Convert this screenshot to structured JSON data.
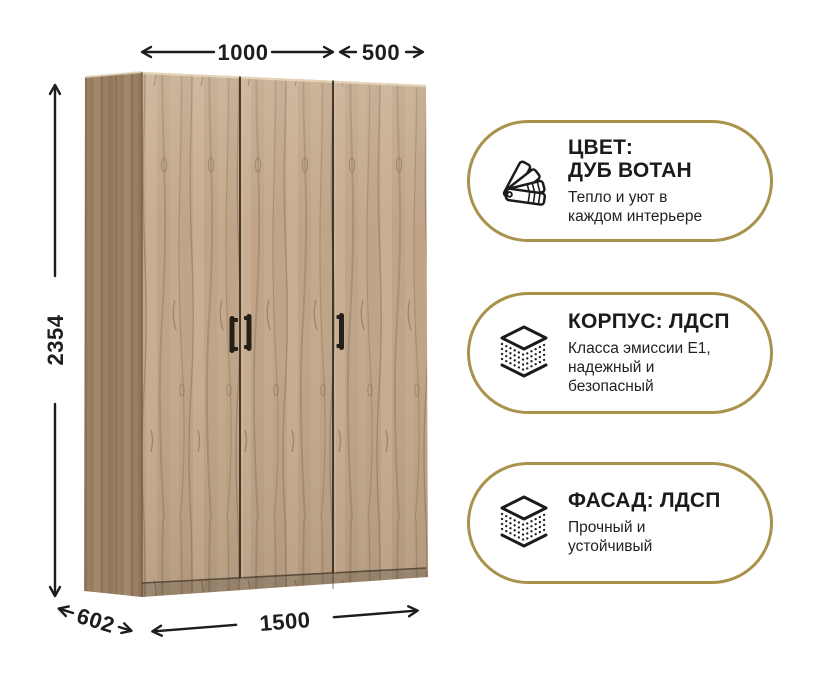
{
  "colors": {
    "accent_gold": "#a8924c",
    "text": "#1d1d1d",
    "wood_front": "#bfa487",
    "wood_side": "#a4886a",
    "handle": "#241f19"
  },
  "dimensions": {
    "top_left_width": "1000",
    "top_right_width": "500",
    "height": "2354",
    "depth": "602",
    "total_width": "1500"
  },
  "badges": [
    {
      "icon": "color-swatch-fan-icon",
      "title_line1": "ЦВЕТ:",
      "title_line2": "ДУБ ВОТАН",
      "sub_line1": "Тепло и уют в",
      "sub_line2": "каждом интерьере"
    },
    {
      "icon": "layered-board-icon",
      "title_line1": "КОРПУС: ЛДСП",
      "sub_line1": "Класса эмиссии Е1,",
      "sub_line2": "надежный и",
      "sub_line3": "безопасный"
    },
    {
      "icon": "layered-board-icon",
      "title_line1": "ФАСАД: ЛДСП",
      "sub_line1": "Прочный и",
      "sub_line2": "устойчивый"
    }
  ]
}
